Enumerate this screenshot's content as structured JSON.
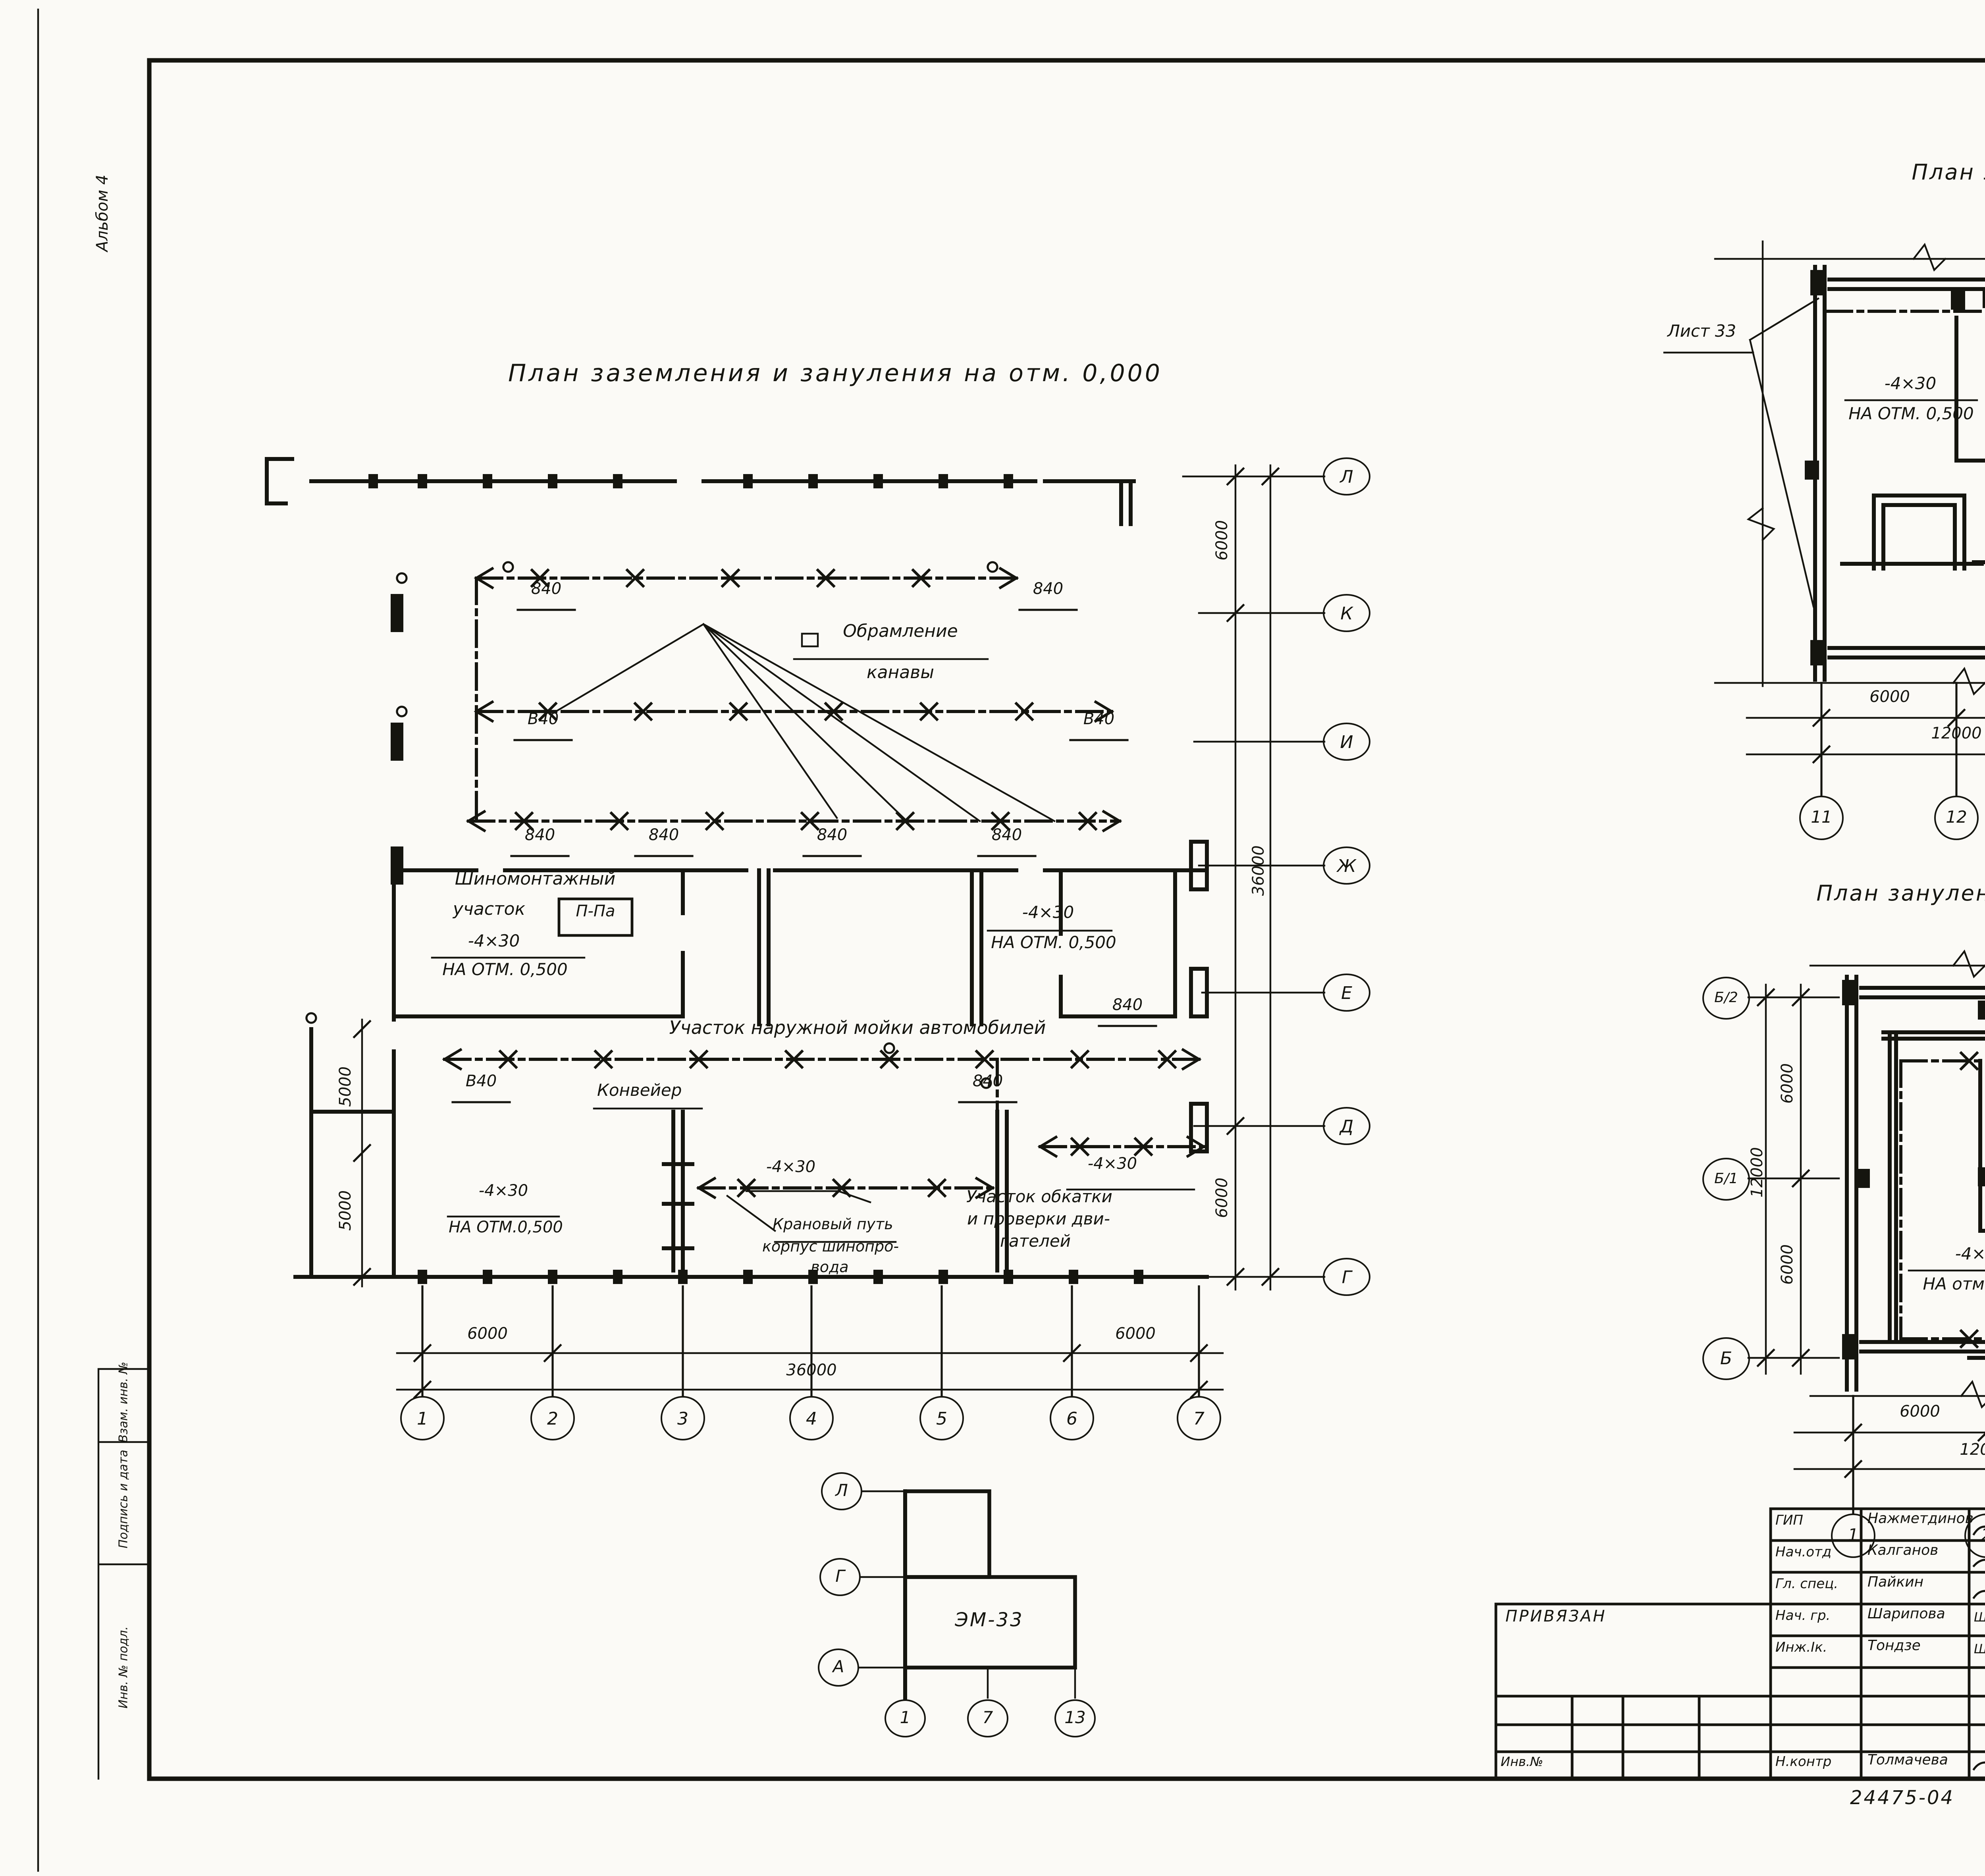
{
  "sheet": {
    "page_number": "59",
    "album": "Альбом 4",
    "margin_boxes": [
      "Взам. инв. №",
      "Подпись и дата",
      "Инв. № подл."
    ]
  },
  "main_plan": {
    "title": "План заземления и зануления на отм. 0,000",
    "axes_rows": [
      "Л",
      "К",
      "И",
      "Ж",
      "Е",
      "Д",
      "Г"
    ],
    "axes_cols": [
      "1",
      "2",
      "3",
      "4",
      "5",
      "6",
      "7"
    ],
    "dim_6000": "6000",
    "dim_36000": "36000",
    "dim_5000": "5000",
    "label_840": "840",
    "label_v40": "В40",
    "note_obramlenie_1": "Обрамление",
    "note_obramlenie_2": "канавы",
    "room_shinomontazh_1": "Шиномонтажный",
    "room_shinomontazh_2": "участок",
    "room_shinomontazh_badge": "П-Па",
    "cond_4x30": "-4×30",
    "note_otm_a": "НА ОТМ. 0,500",
    "note_otm_b": "НА ОТМ.0,500",
    "room_moyka": "Участок наружной мойки автомобилей",
    "note_konveyer": "Конвейер",
    "room_kranovy_1": "Крановый путь",
    "room_kranovy_2": "корпус шинопро-",
    "room_kranovy_3": "вода",
    "room_obkatka_1": "Участок обкатки",
    "room_obkatka_2": "и проверки дви-",
    "room_obkatka_3": "гателей"
  },
  "plan_top_right": {
    "title": "План зануления на отм. 3.600",
    "note_list33": "Лист 33",
    "cond_4x30": "-4×30",
    "note_otm": "НА ОТМ. 0,500",
    "axes_rows": [
      "Б",
      "А/2",
      "А/1"
    ],
    "axes_cols": [
      "11",
      "12",
      "13"
    ],
    "dim_6000": "6000",
    "dim_12000": "12000"
  },
  "plan_mid_right": {
    "title": "План зануления на отм. 3,600",
    "note_list33": "Лист 33",
    "cond_4x30": "-4×30",
    "note_otm": "НА отм.0,500",
    "axes_rows": [
      "Б/2",
      "Б/1",
      "Б"
    ],
    "axes_cols": [
      "1",
      "2",
      "3"
    ],
    "dim_6000": "6000",
    "dim_12000": "12000"
  },
  "key_plan": {
    "label": "ЭМ-33",
    "axes_rows": [
      "Л",
      "Г",
      "А"
    ],
    "axes_cols": [
      "1",
      "7",
      "13"
    ]
  },
  "title_block": {
    "doc_number": "503-1-78.90-ЭМ",
    "signoff": [
      {
        "role": "ГИП",
        "name": "Нажметдинов",
        "date": "07.90"
      },
      {
        "role": "Нач.отд",
        "name": "Калганов",
        "date": "07.90"
      },
      {
        "role": "Гл. спец.",
        "name": "Пайкин",
        "date": "07.90"
      },
      {
        "role": "Нач. гр.",
        "name": "Шарипова",
        "sig": "Шарип.",
        "date": "07.90"
      },
      {
        "role": "Инж.Iк.",
        "name": "Тондзе",
        "sig": "Шарип.",
        "date": "07.90"
      }
    ],
    "ncontr": {
      "role": "Н.контр",
      "name": "Толмачева",
      "date": "07.90"
    },
    "privyazan": "ПРИВЯЗАН",
    "inv_no": "Инв.№",
    "project_lines": [
      "Производственный корпус",
      "автотранспортного предприя-",
      "тия „Агропромтранс\" на 250",
      "грузовых автомобилей"
    ],
    "sheet_title_lines": [
      "Планы заземления и зану-",
      "ления на отм. 0.000,",
      "зануления на отм. 3.600"
    ],
    "stage_header": [
      "Стадия",
      "Лист",
      "Листов"
    ],
    "stage": "РП",
    "sheet_no": "32",
    "org": "ГИПРОПРОМСЕЛЬСТРОЙ",
    "org_city": "г. САРАТОВ"
  },
  "footer": {
    "order_no": "24475-04",
    "copies": "35",
    "copied_label": "Копировал:",
    "copied_by": "Савина С.",
    "format": "Формат А2"
  }
}
